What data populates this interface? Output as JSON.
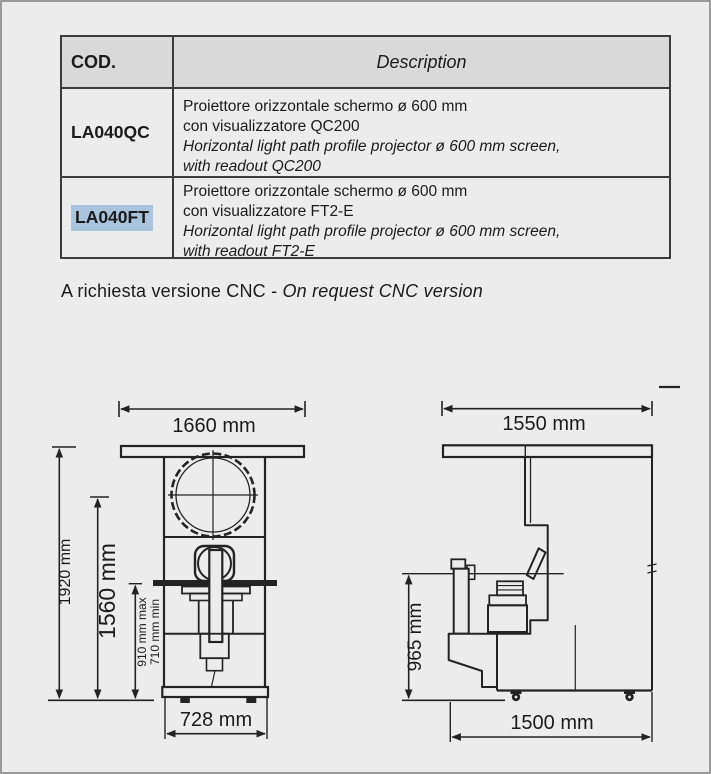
{
  "table": {
    "header": {
      "cod": "COD.",
      "description": "Description"
    },
    "rows": [
      {
        "cod": "LA040QC",
        "highlighted": false,
        "lines": [
          "Proiettore orizzontale schermo ø 600 mm",
          "con visualizzatore QC200",
          "Horizontal light path profile projector ø 600 mm screen,",
          "with readout QC200"
        ]
      },
      {
        "cod": "LA040FT",
        "highlighted": true,
        "lines": [
          "Proiettore orizzontale schermo ø 600 mm",
          "con visualizzatore FT2-E",
          "Horizontal light path profile projector ø 600 mm screen,",
          "with readout FT2-E"
        ]
      }
    ]
  },
  "note": {
    "italian": "A richiesta versione CNC - ",
    "english": "On request CNC version"
  },
  "drawings": {
    "front_view": {
      "width_top": "1660 mm",
      "height_total": "1920 mm",
      "height_screen_center": "1560 mm",
      "stage_height_max": "910 mm max",
      "stage_height_min": "710 mm min",
      "width_base": "728 mm"
    },
    "side_view": {
      "depth_top": "1550 mm",
      "stage_height": "965 mm",
      "depth_base": "1500 mm"
    }
  },
  "colors": {
    "page_background": "#ececec",
    "table_header_background": "#d9d9d9",
    "code_highlight": "#a9c4dc",
    "line_color": "#232323",
    "text_color": "#1b1b1b"
  }
}
